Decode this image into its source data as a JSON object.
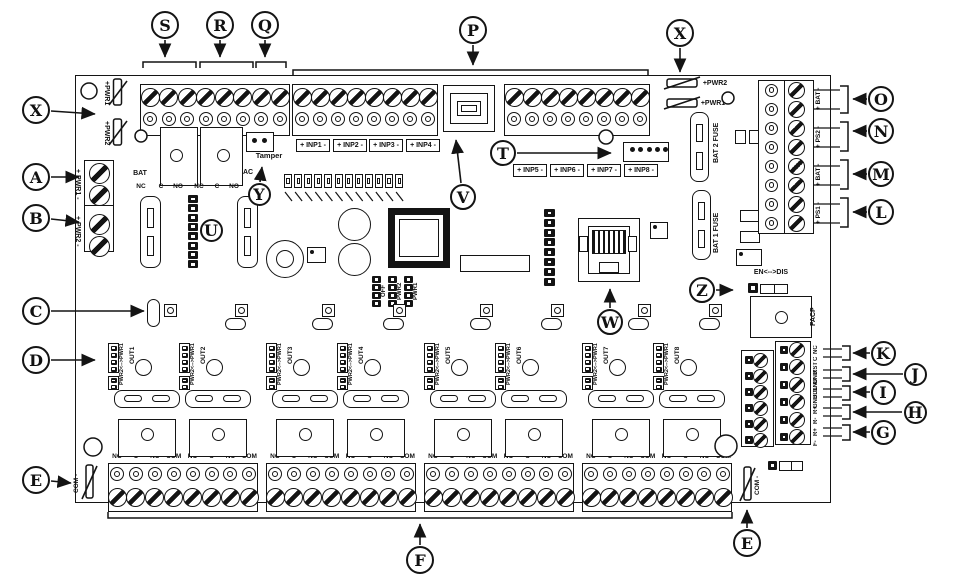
{
  "callouts": [
    {
      "letter": "S"
    },
    {
      "letter": "R"
    },
    {
      "letter": "Q"
    },
    {
      "letter": "P"
    },
    {
      "letter": "X"
    },
    {
      "letter": "T"
    },
    {
      "letter": "V"
    },
    {
      "letter": "Y"
    },
    {
      "letter": "U"
    },
    {
      "letter": "W"
    },
    {
      "letter": "Z"
    },
    {
      "letter": "O"
    },
    {
      "letter": "N"
    },
    {
      "letter": "M"
    },
    {
      "letter": "L"
    },
    {
      "letter": "K"
    },
    {
      "letter": "J"
    },
    {
      "letter": "I"
    },
    {
      "letter": "H"
    },
    {
      "letter": "G"
    },
    {
      "letter": "A"
    },
    {
      "letter": "B"
    },
    {
      "letter": "C"
    },
    {
      "letter": "D"
    },
    {
      "letter": "E"
    },
    {
      "letter": "F"
    },
    {
      "letter": "X"
    },
    {
      "letter": "E"
    }
  ],
  "labels": {
    "tamper": "Tamper",
    "bat_relay": "BAT",
    "ac_relay": "AC",
    "relay_contacts": [
      "NC",
      "C",
      "NO"
    ],
    "fuse_left": [
      "+PWR1",
      "+PWR2"
    ],
    "fuse_right": [
      "+PWR2",
      "+PWR1"
    ],
    "power_in": [
      "+ PWR1 -",
      "+ PWR2 -"
    ],
    "bat_fuses": [
      "BAT 2 FUSE",
      "BAT 1 FUSE"
    ],
    "dc_out": [
      "+ BAT -",
      "+ PS2 -",
      "+ BAT -",
      "+ PS1 -"
    ],
    "en_dis": "EN<-->DIS",
    "facp": "FACP",
    "pwr_select": [
      "OFF",
      "PWR2",
      "PWR1"
    ],
    "out_jumper": "PWR2<-->PWR1",
    "outputs": [
      "OUT1",
      "OUT2",
      "OUT3",
      "OUT4",
      "OUT5",
      "OUT6",
      "OUT7",
      "OUT8"
    ],
    "out_contacts": [
      "NO",
      "C",
      "NC",
      "COM"
    ],
    "com_fuse": "COM -",
    "inputs": [
      "+ INP1 -",
      "+ INP2 -",
      "+ INP3 -",
      "+ INP4 -",
      "+ INP5 -",
      "+ INP6 -",
      "+ INP7 -",
      "+ INP8 -"
    ],
    "reader": [
      "NC",
      "C",
      "RST",
      "GND",
      "GND",
      "BDL",
      "GND",
      "R+",
      "R-",
      "R+",
      "F-"
    ]
  }
}
